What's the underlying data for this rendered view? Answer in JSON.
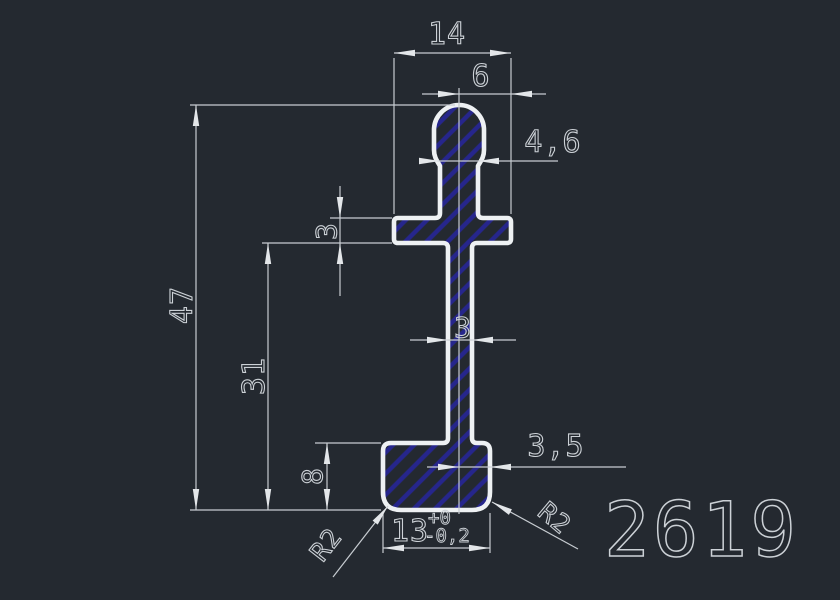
{
  "title": {
    "profile_number": "2619"
  },
  "dims": {
    "arm_width": "14",
    "center_to_arm_right": "6",
    "neck_width": "4,6",
    "arm_thickness": "3",
    "overall_height": "47",
    "stem_height": "31",
    "stem_width": "3",
    "foot_height": "8",
    "center_to_foot_right": "3,5",
    "foot_width": "13",
    "foot_tol_plus": "+0",
    "foot_tol_minus": "-0,2",
    "radius_bottom_left": "R2",
    "radius_bottom_right": "R2"
  },
  "colors": {
    "background": "#242930",
    "outline": "#eef1f3",
    "hatch": "#26268c",
    "dim": "#c7ccd1",
    "text": "#ccd1d6",
    "arrow": "#e3e6e9"
  }
}
